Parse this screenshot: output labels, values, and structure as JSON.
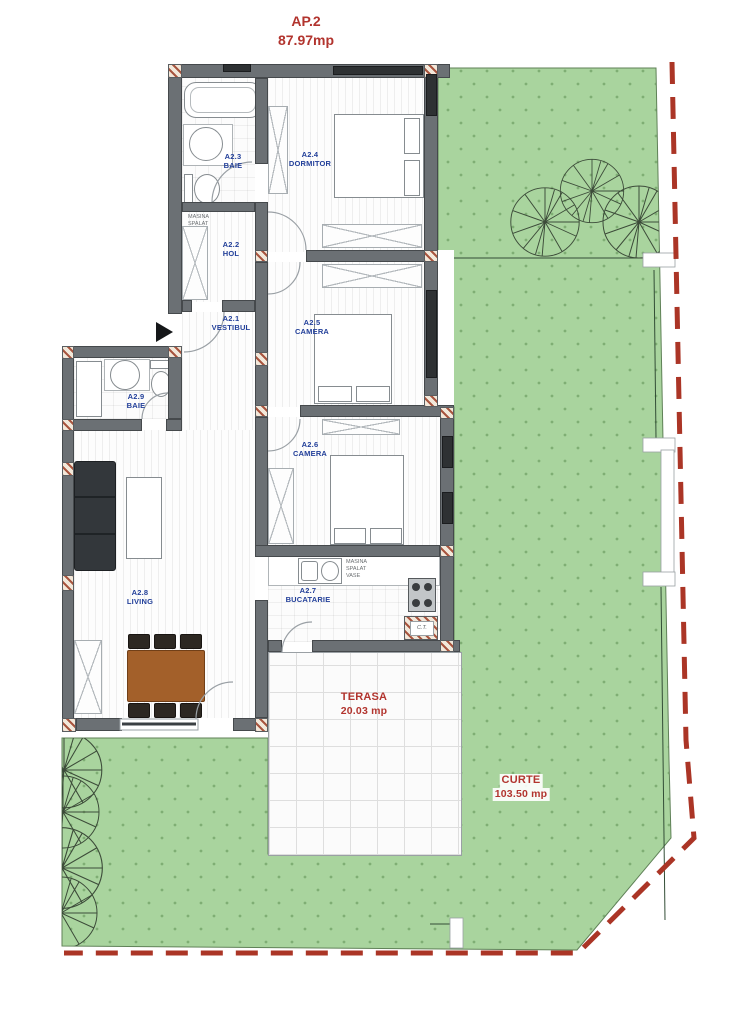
{
  "title": {
    "code": "AP.2",
    "area": "87.97mp"
  },
  "rooms": [
    {
      "code": "A2.1",
      "name": "VESTIBUL"
    },
    {
      "code": "A2.2",
      "name": "HOL"
    },
    {
      "code": "A2.3",
      "name": "BAIE"
    },
    {
      "code": "A2.4",
      "name": "DORMITOR"
    },
    {
      "code": "A2.5",
      "name": "CAMERA"
    },
    {
      "code": "A2.6",
      "name": "CAMERA"
    },
    {
      "code": "A2.7",
      "name": "BUCATARIE"
    },
    {
      "code": "A2.8",
      "name": "LIVING"
    },
    {
      "code": "A2.9",
      "name": "BAIE"
    }
  ],
  "outdoor": {
    "terrace": {
      "name": "TERASA",
      "area": "20.03 mp"
    },
    "yard": {
      "name": "CURTE",
      "area": "103.50 mp"
    }
  },
  "appliances": {
    "washer": {
      "line1": "MASINA",
      "line2": "SPALAT"
    },
    "dishwasher": {
      "line1": "MASINA",
      "line2": "SPALAT",
      "line3": "VASE"
    },
    "boiler": "C.T."
  },
  "colors": {
    "label_red": "#b2342e",
    "label_blue": "#23409a",
    "grass": "#a9d49e",
    "grass_dot": "#7fae74",
    "boundary_red": "#ab3526",
    "wall_gray": "#6b7074",
    "window_dark": "#2e3133"
  }
}
